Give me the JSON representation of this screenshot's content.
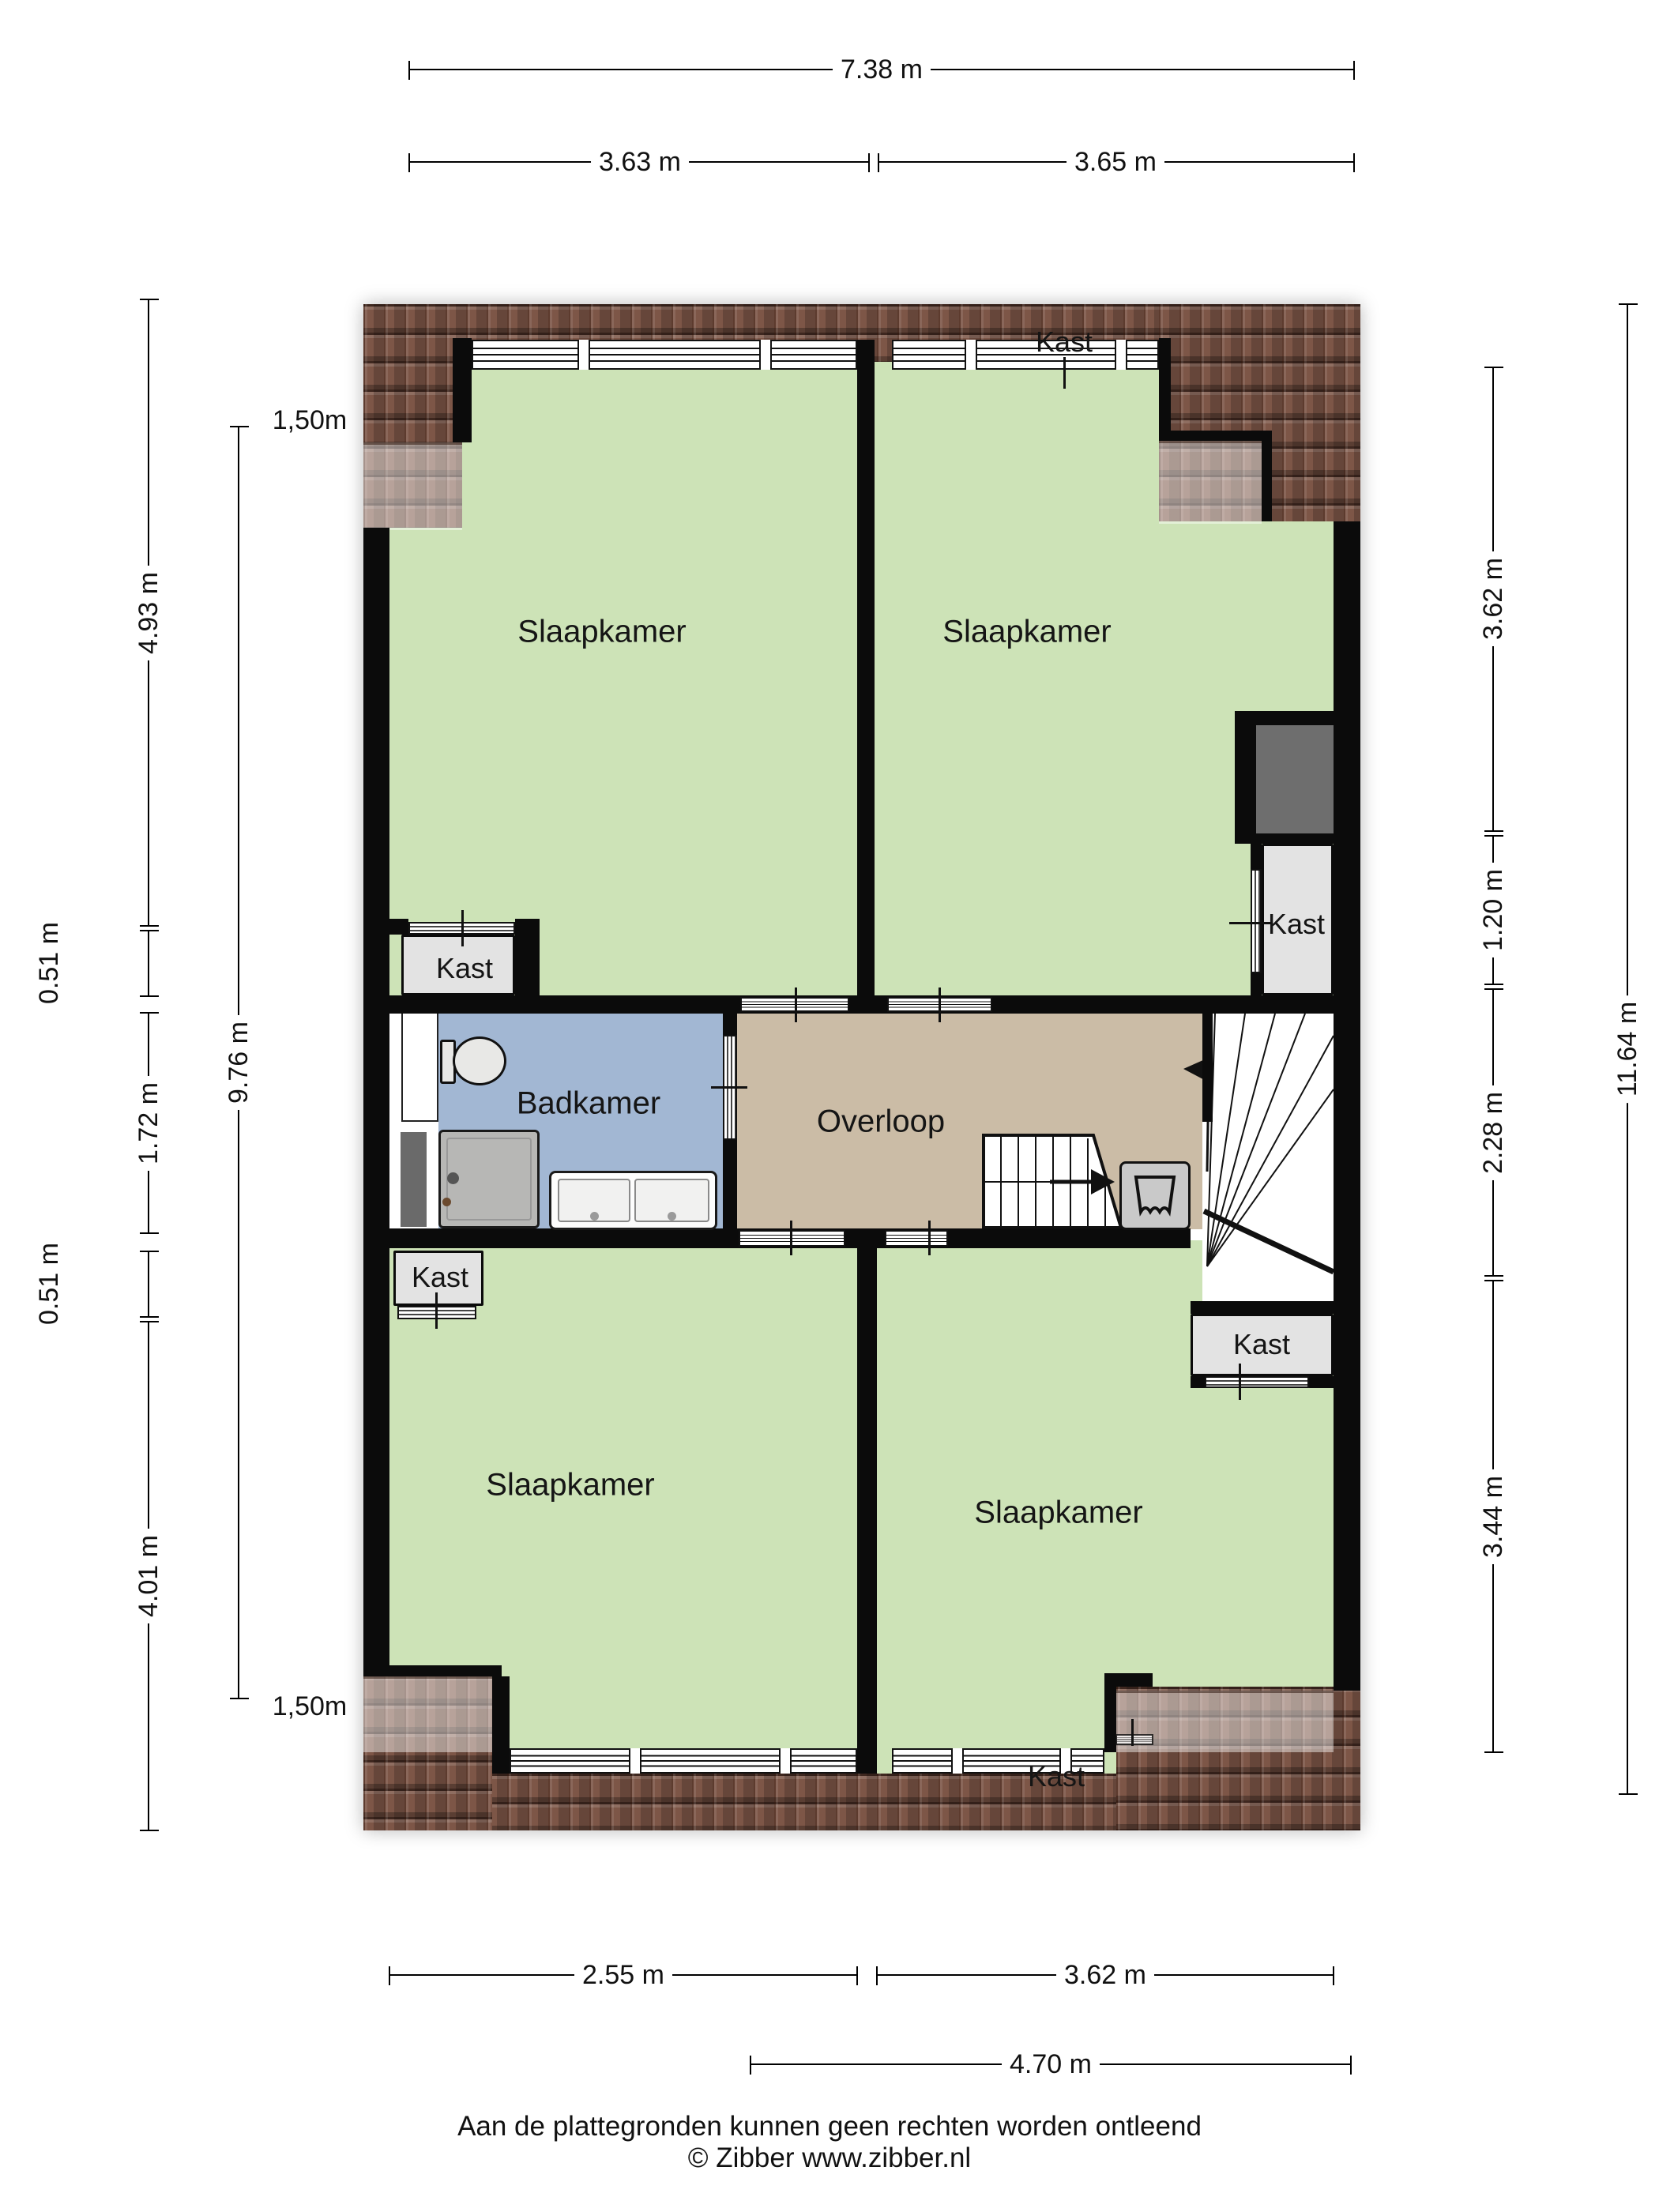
{
  "rooms": {
    "bedroom": "Slaapkamer",
    "bathroom": "Badkamer",
    "landing": "Overloop",
    "closet": "Kast"
  },
  "dimensions": {
    "top": {
      "total": "7.38 m",
      "left_segment": "3.63 m",
      "right_segment": "3.65 m"
    },
    "bottom": {
      "left_segment": "2.55 m",
      "right_segment": "3.62 m",
      "total": "4.70 m"
    },
    "left": {
      "height_mark_top": "1,50m",
      "height_mark_bottom": "1,50m",
      "inner_total": "9.76 m",
      "segments": [
        "4.93 m",
        "0.51 m",
        "1.72 m",
        "0.51 m",
        "4.01 m"
      ]
    },
    "right": {
      "segments": [
        "3.62 m",
        "1.20 m",
        "2.28 m",
        "3.44 m"
      ],
      "outer_total": "11.64 m"
    }
  },
  "footer": {
    "disclaimer": "Aan de plattegronden kunnen geen rechten worden ontleend",
    "copyright": "© Zibber www.zibber.nl"
  },
  "colors": {
    "bedroom": "#cde3b7",
    "bathroom": "#a2b7d3",
    "landing": "#cbbca6",
    "closet": "#e3e3e3",
    "roof": "#7d5647",
    "wall": "#0b0b0b"
  }
}
